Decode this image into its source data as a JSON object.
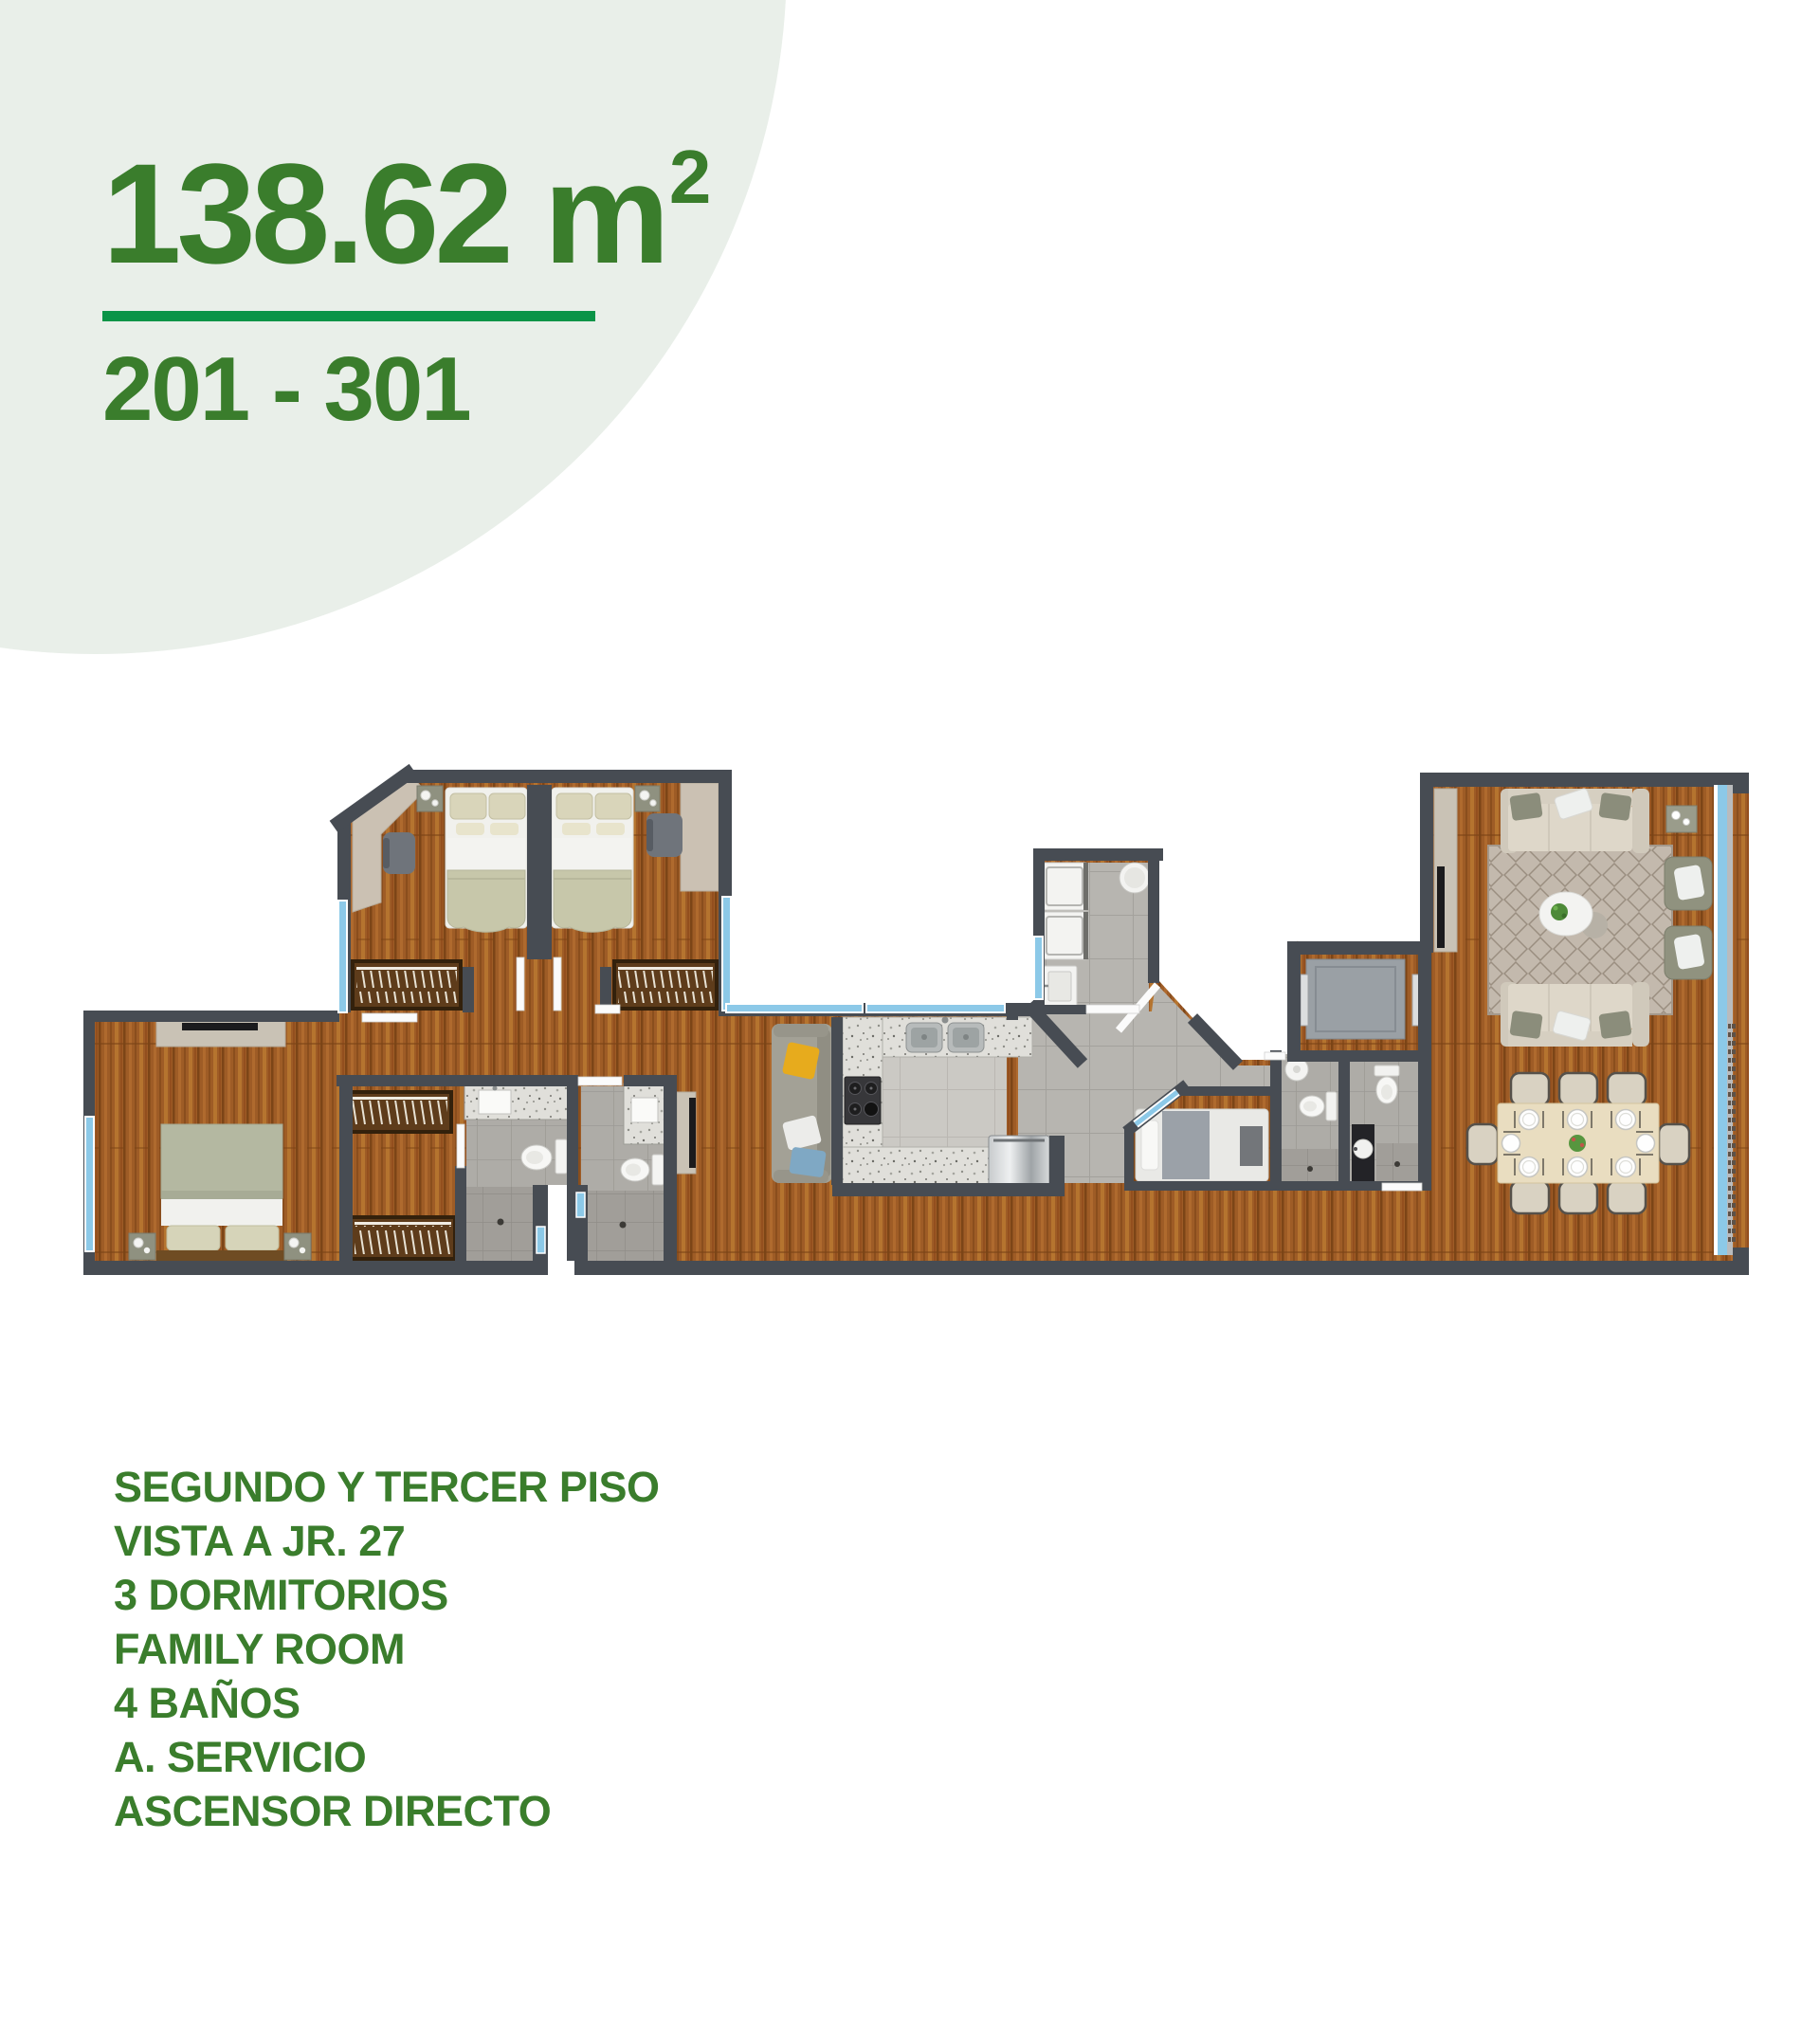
{
  "header": {
    "area_label": "138.62 m",
    "area_exponent": "2",
    "units_range": "201 - 301"
  },
  "features": {
    "lines": [
      "SEGUNDO Y TERCER PISO",
      "VISTA A JR. 27",
      "3 DORMITORIOS",
      "FAMILY ROOM",
      "4 BAÑOS",
      "A. SERVICIO",
      "ASCENSOR DIRECTO"
    ]
  },
  "colors": {
    "accent_green": "#3a7d2c",
    "underline_green": "#0a9447",
    "circle_background": "#e9efe9",
    "wall_gray": "#474c53",
    "window_blue": "#8cc9e8",
    "wood_floor": "#9e5c26",
    "tile_gray": "#b7b5b0",
    "counter_granite": "#e0dfda"
  }
}
